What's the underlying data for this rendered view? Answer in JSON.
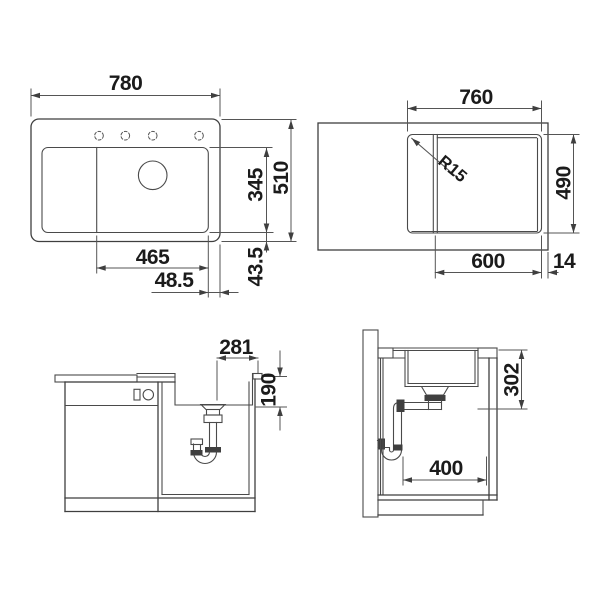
{
  "drawing": {
    "background": "#ffffff",
    "line_color": "#3f3f3f",
    "text_color": "#1b1b1b",
    "views": {
      "top_view": {
        "dims": {
          "overall_width": "780",
          "overall_depth": "510",
          "bowl_depth": "345",
          "bowl_width": "465",
          "offset_right": "48.5",
          "offset_bottom": "43.5"
        }
      },
      "cutout_view": {
        "dims": {
          "cutout_width": "760",
          "cutout_depth": "490",
          "corner_radius": "R15",
          "section_width": "600",
          "edge_gap": "14"
        }
      },
      "front_section": {
        "dims": {
          "drain_offset": "281",
          "bowl_inner_depth": "190"
        }
      },
      "side_section": {
        "dims": {
          "install_depth": "302",
          "base_width": "400"
        }
      }
    }
  }
}
